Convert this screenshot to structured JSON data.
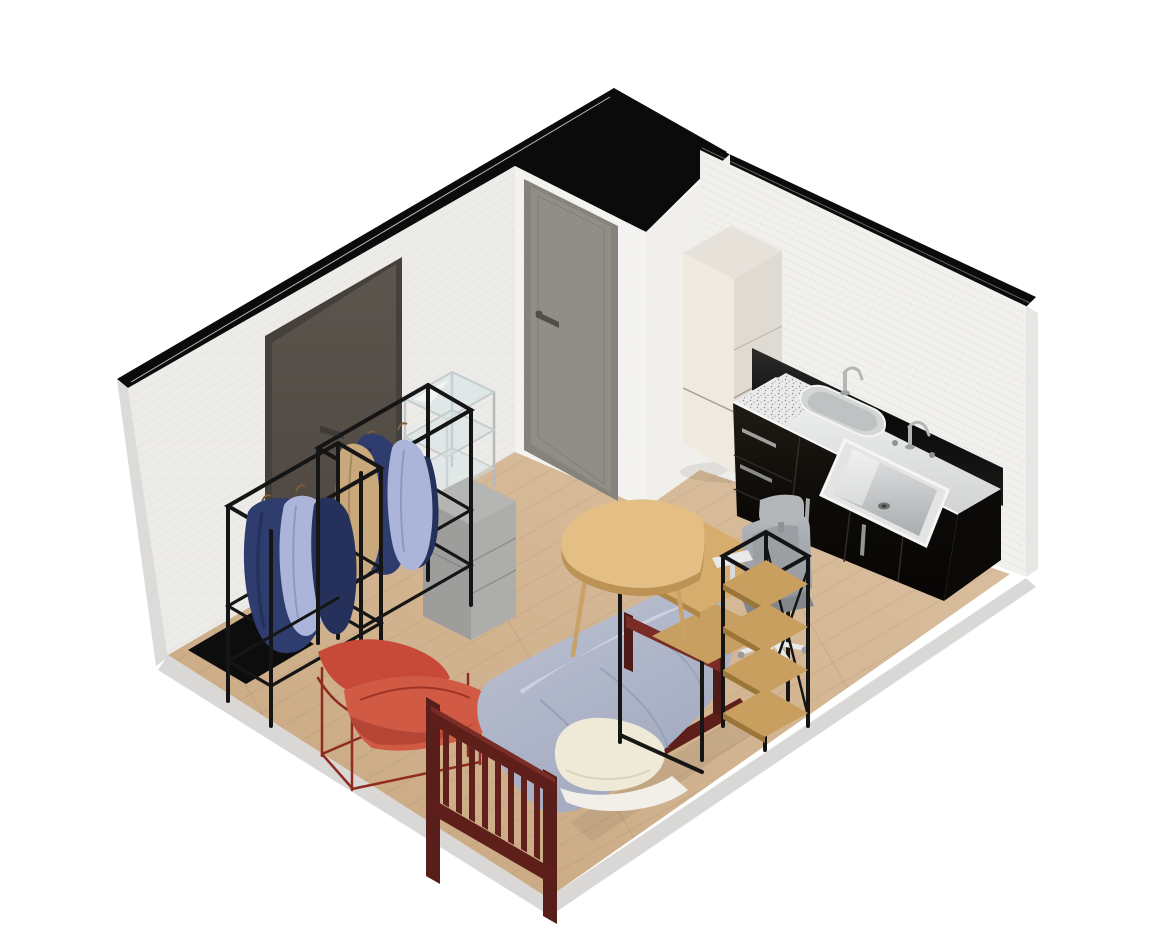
{
  "canvas": {
    "width": 1170,
    "height": 934
  },
  "scene": {
    "background": "#ffffff",
    "structure": {
      "ceiling_edge": "#0b0b0b",
      "left_wall": "#ecebe8",
      "door_wall": "#f4f3f1",
      "niche_wall": "#f0efec",
      "tiled_wall": "#f1f0ed",
      "wall_outer_edge": "#dcdbd9",
      "right_wall_edge": "#e7e6e4",
      "floor_light": "#dcc1a1",
      "floor_dark": "#c7a67f",
      "plinth": "#d9d8d6"
    },
    "furniture": {
      "entry_door": {
        "name": "entry door",
        "frame": "#46403a",
        "panel": "#59524b",
        "handle": "#3e3b37"
      },
      "interior_door": {
        "name": "interior door",
        "frame": "#86837c",
        "panel": "#908e87",
        "handle": "#504e49"
      },
      "door_mat": {
        "name": "door mat",
        "color": "#0d0d0d"
      },
      "clothes_rack": {
        "name": "clothing rack",
        "frame": "#151515",
        "jacket": "#2e3c6e",
        "jacket_dark": "#25315b",
        "shirt": "#abb4d9",
        "coat": "#c9a97c"
      },
      "glass_shelf": {
        "name": "glass shelf unit",
        "frame": "#bdc2c4",
        "glass": "#d9e4e6"
      },
      "storage_cabinet": {
        "name": "storage cabinet",
        "top": "#b5b6b4",
        "left": "#9d9e9c",
        "right": "#adaeac"
      },
      "lounge_chair": {
        "name": "lounge chair",
        "cushion": "#c64a37",
        "cushion_light": "#d15a45",
        "frame": "#8f2b20"
      },
      "bed": {
        "name": "single bed",
        "frame": "#5e1f1a",
        "frame_light": "#7a2d26",
        "duvet": "#afb5c8",
        "pillow": "#efe9d8",
        "sheet": "#f2efe8"
      },
      "round_desk": {
        "name": "round desk",
        "top": "#e3bf86",
        "edge": "#bd9355",
        "leg": "#c9a267"
      },
      "computer_desk": {
        "name": "computer desk",
        "top": "#d6ad6d",
        "frame": "#161616"
      },
      "office_chair": {
        "name": "office chair",
        "back": "#a6aaae",
        "headrest": "#b4b7ba",
        "seat": "#83878b",
        "base": "#e8e9ea"
      },
      "bookshelf": {
        "name": "ladder bookshelf",
        "frame": "#141414",
        "shelf": "#c99f60"
      },
      "refrigerator": {
        "name": "refrigerator",
        "top": "#e6e2da",
        "front": "#efe9e0",
        "side": "#e0dbd2"
      },
      "kitchen_counter": {
        "name": "kitchen counter",
        "cabinet": "#17130e",
        "cabinet_side": "#0c0a08",
        "backsplash": "#111010",
        "counter_top": "#e9eaea",
        "sink": "#e3e4e4"
      }
    }
  }
}
